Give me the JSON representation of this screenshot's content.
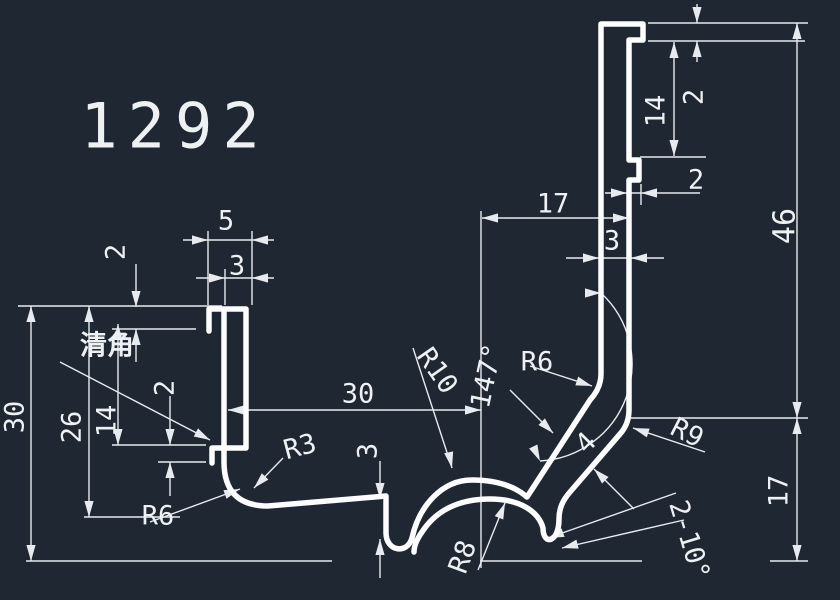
{
  "app": "cad-viewport",
  "canvas": {
    "width": 840,
    "height": 600,
    "background_color": "#1f2733",
    "profile_line_color": "#fcfdfe",
    "dimension_line_color": "#e7ebef"
  },
  "drawing": {
    "part_number": "1292",
    "note": "清角",
    "labels": [
      {
        "id": "part-number",
        "text": "1292",
        "x": 175,
        "y": 126,
        "size": 62,
        "rot": 0,
        "spacing": 10
      },
      {
        "id": "dim-5-top-left",
        "text": "5",
        "x": 226,
        "y": 221,
        "size": 27,
        "rot": 0
      },
      {
        "id": "dim-3-top-left",
        "text": "3",
        "x": 237,
        "y": 266,
        "size": 27,
        "rot": 0
      },
      {
        "id": "dim-2-left-upper",
        "text": "2",
        "x": 116,
        "y": 252,
        "size": 27,
        "rot": -90
      },
      {
        "id": "note-qingjiao",
        "text": "清角",
        "x": 107,
        "y": 346,
        "size": 27,
        "rot": 0,
        "cjk": true
      },
      {
        "id": "dim-30-left",
        "text": "30",
        "x": 15,
        "y": 417,
        "size": 27,
        "rot": -90
      },
      {
        "id": "dim-26-left",
        "text": "26",
        "x": 72,
        "y": 427,
        "size": 27,
        "rot": -90
      },
      {
        "id": "dim-14-left",
        "text": "14",
        "x": 107,
        "y": 421,
        "size": 27,
        "rot": -90
      },
      {
        "id": "dim-2-left-lower",
        "text": "2",
        "x": 165,
        "y": 388,
        "size": 27,
        "rot": -90
      },
      {
        "id": "dim-r6-bottom-left",
        "text": "R6",
        "x": 158,
        "y": 516,
        "size": 27,
        "rot": 0
      },
      {
        "id": "dim-r3",
        "text": "R3",
        "x": 300,
        "y": 447,
        "size": 27,
        "rot": -15
      },
      {
        "id": "dim-30-bottom",
        "text": "30",
        "x": 358,
        "y": 394,
        "size": 27,
        "rot": 0
      },
      {
        "id": "dim-3-bottom",
        "text": "3",
        "x": 368,
        "y": 451,
        "size": 27,
        "rot": -90
      },
      {
        "id": "dim-r10",
        "text": "R10",
        "x": 437,
        "y": 371,
        "size": 27,
        "rot": 55
      },
      {
        "id": "dim-147deg",
        "text": "147°",
        "x": 487,
        "y": 376,
        "size": 27,
        "rot": -78
      },
      {
        "id": "dim-r6-bend",
        "text": "R6",
        "x": 537,
        "y": 362,
        "size": 27,
        "rot": 0
      },
      {
        "id": "dim-r8",
        "text": "R8",
        "x": 463,
        "y": 557,
        "size": 27,
        "rot": -70
      },
      {
        "id": "dim-4-slot",
        "text": "4",
        "x": 586,
        "y": 443,
        "size": 27,
        "rot": -45
      },
      {
        "id": "dim-r9",
        "text": "R9",
        "x": 687,
        "y": 433,
        "size": 27,
        "rot": 27
      },
      {
        "id": "dim-2-10deg",
        "text": "2-10°",
        "x": 689,
        "y": 540,
        "size": 27,
        "rot": 73
      },
      {
        "id": "dim-17-top",
        "text": "17",
        "x": 553,
        "y": 204,
        "size": 27,
        "rot": 0
      },
      {
        "id": "dim-3-top-center",
        "text": "3",
        "x": 612,
        "y": 241,
        "size": 27,
        "rot": 0
      },
      {
        "id": "dim-2-lip-top",
        "text": "2",
        "x": 696,
        "y": 180,
        "size": 27,
        "rot": 0
      },
      {
        "id": "dim-14-top-right",
        "text": "14",
        "x": 656,
        "y": 111,
        "size": 27,
        "rot": -90
      },
      {
        "id": "dim-2-top-right",
        "text": "2",
        "x": 694,
        "y": 97,
        "size": 27,
        "rot": -90
      },
      {
        "id": "dim-46-right",
        "text": "46",
        "x": 785,
        "y": 226,
        "size": 30,
        "rot": -90
      },
      {
        "id": "dim-17-right",
        "text": "17",
        "x": 779,
        "y": 491,
        "size": 27,
        "rot": -90
      }
    ]
  }
}
